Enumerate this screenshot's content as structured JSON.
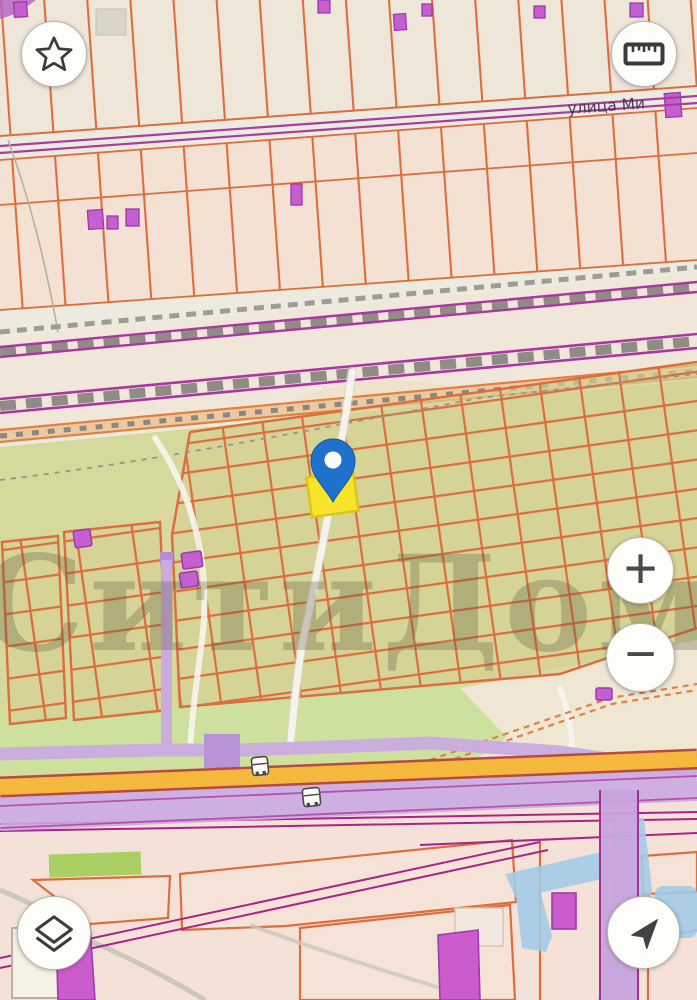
{
  "map": {
    "street_label": "улица Ми",
    "watermark_text": "СитиДом",
    "colors": {
      "pin_fill": "#1e72cd",
      "selected_parcel_fill": "#f8e42b",
      "water_fill": "#a3cbe8",
      "major_road": "#f4b83d",
      "pipeline": "#c9abe2",
      "railway_purple": "#ab35a2",
      "parcel_line": "#dc6e3e",
      "building_fill": "#c55fd0"
    }
  },
  "controls": {
    "favorites_icon": "star",
    "measure_icon": "ruler",
    "zoom_in_label": "+",
    "zoom_out_label": "−",
    "layers_icon": "layers",
    "locate_icon": "navigation-arrow"
  }
}
